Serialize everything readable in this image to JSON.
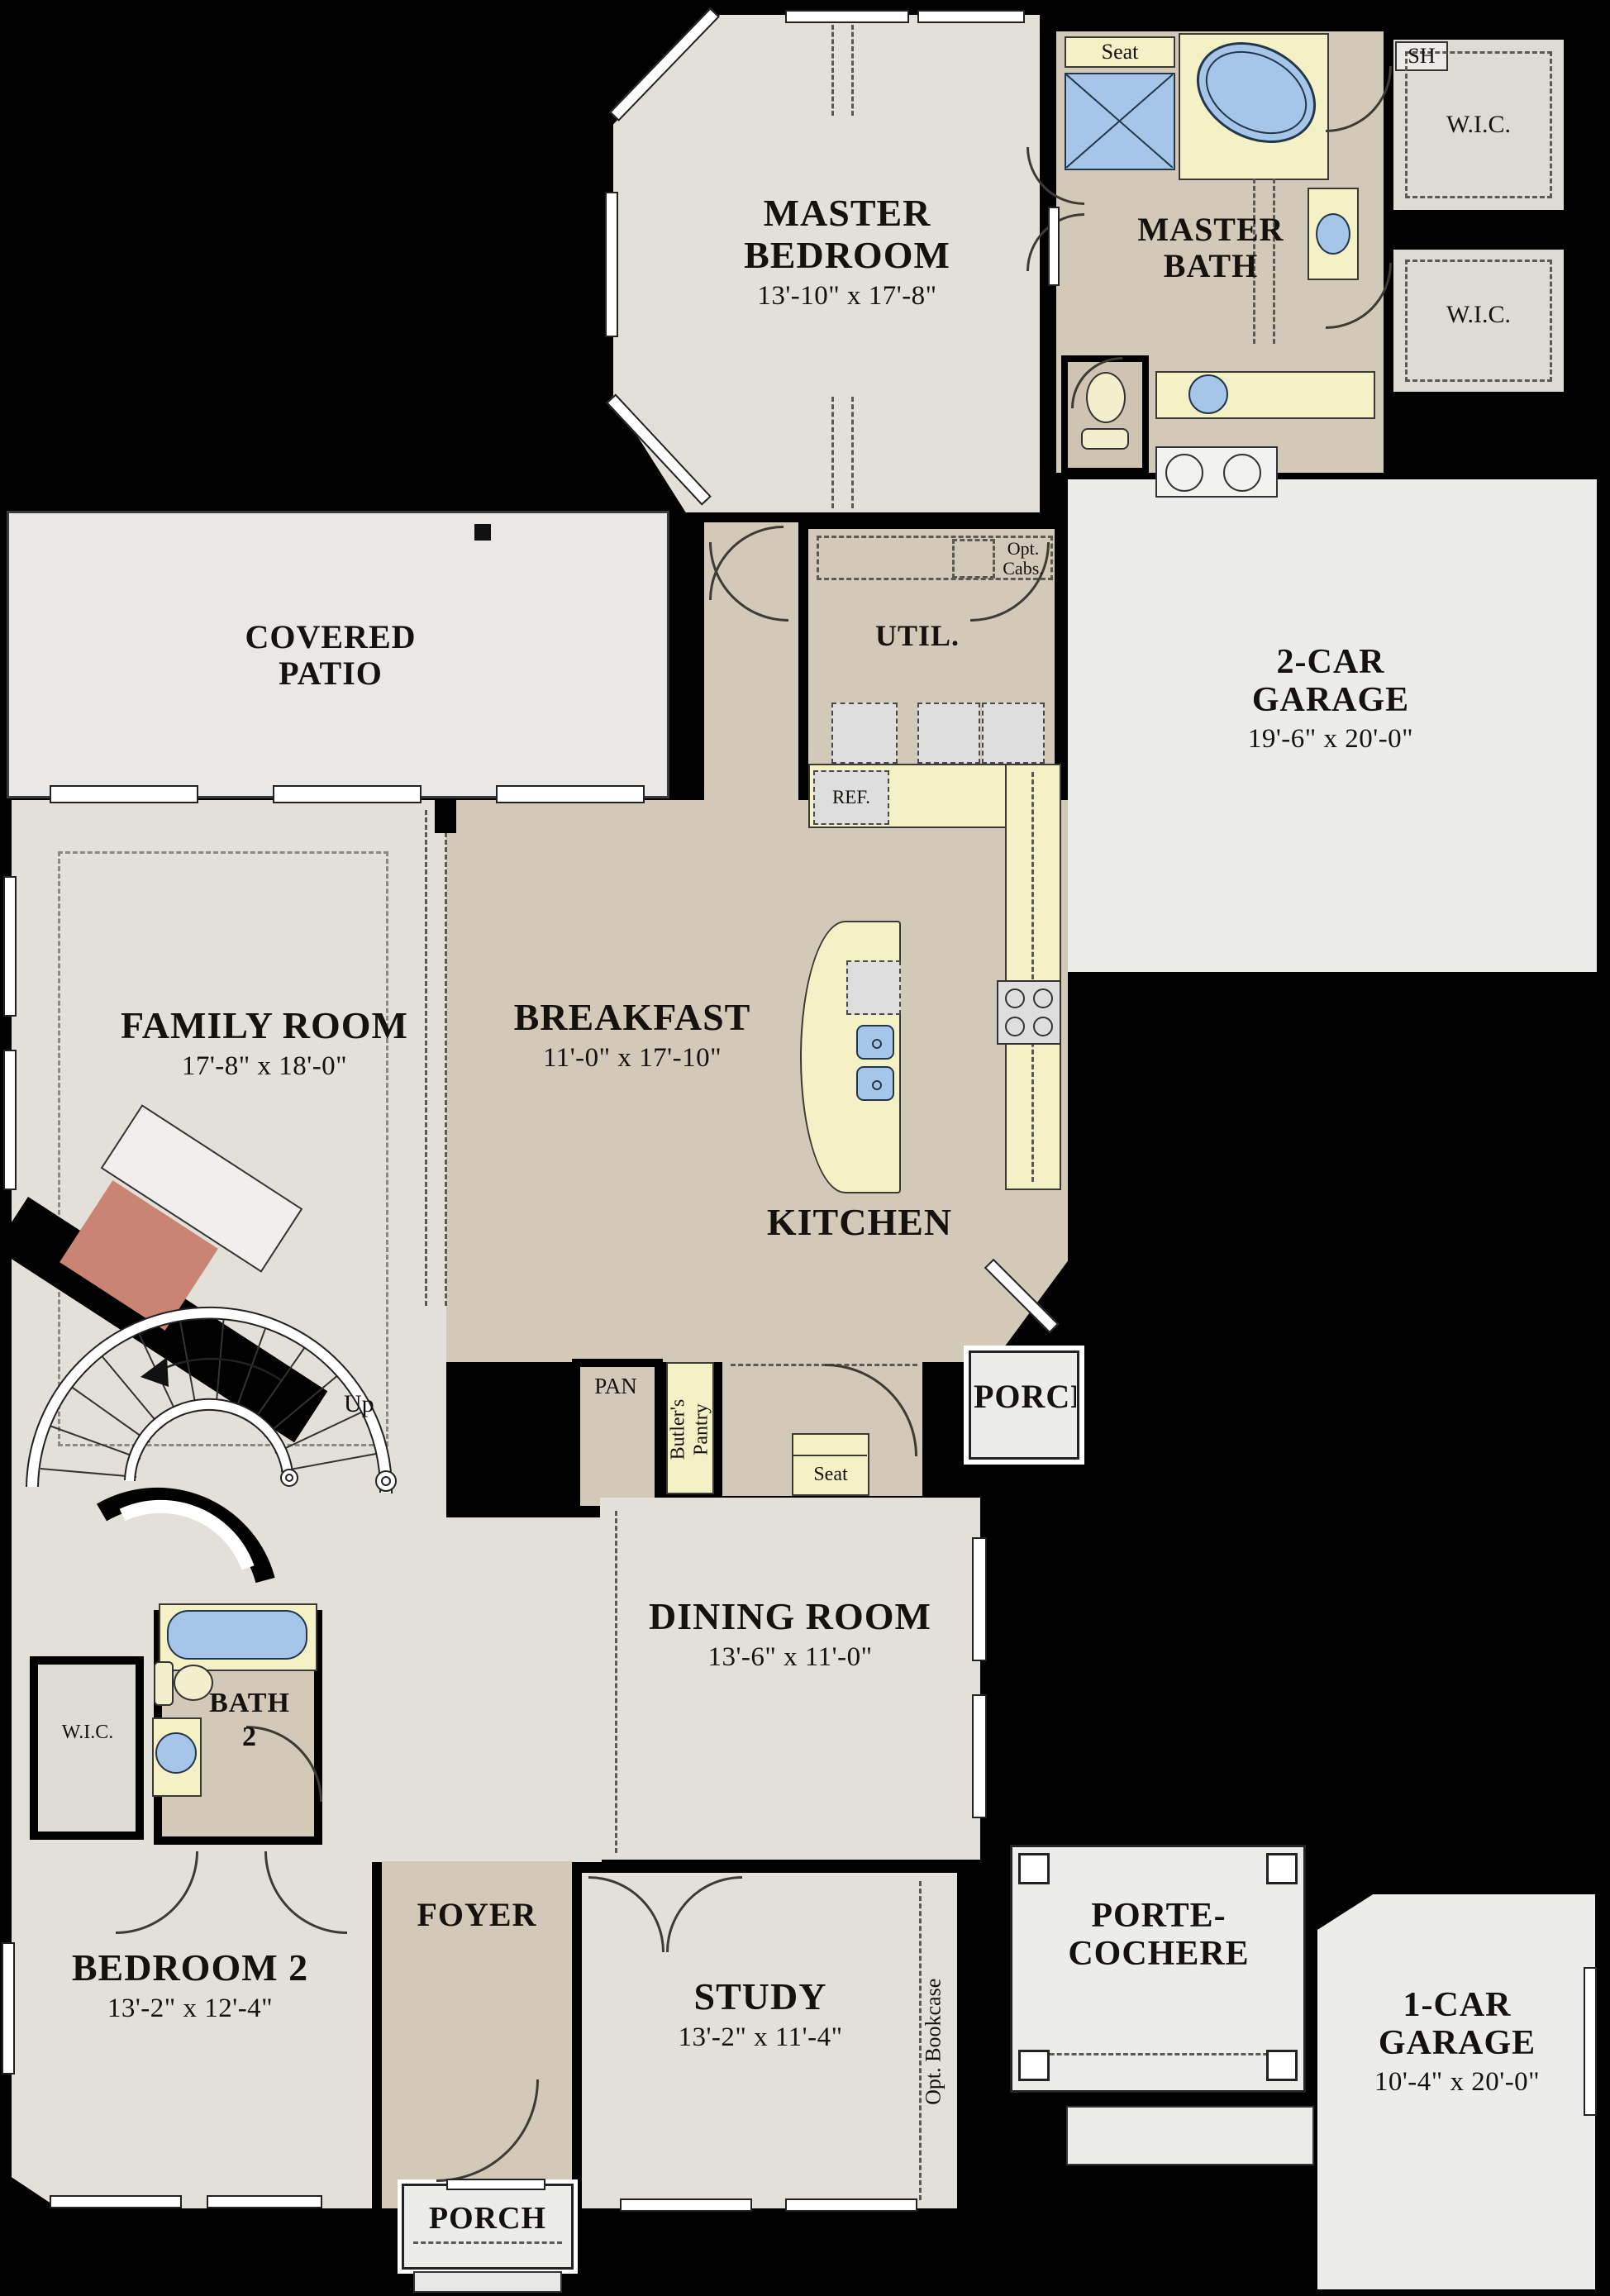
{
  "colors": {
    "background": "#000000",
    "room_light": "#e3e0da",
    "room_tan": "#d3c9b9",
    "room_gray": "#ececea",
    "closet_gray": "#dedbd5",
    "counter_yellow": "#f5f1c6",
    "fixture_blue": "#a5c6e8",
    "fixture_yellow": "#f3efcd",
    "appliance_gray": "#dedede",
    "fireplace": "#c98473",
    "wall": "#000000",
    "line": "#333333"
  },
  "rooms": {
    "master_bedroom": {
      "name": "MASTER BEDROOM",
      "dims": "13'-10\" x 17'-8\""
    },
    "master_bath": {
      "name": "MASTER BATH",
      "seat": "Seat",
      "shower": "SH"
    },
    "wic_master_top": {
      "name": "W.I.C."
    },
    "wic_master_bottom": {
      "name": "W.I.C."
    },
    "covered_patio": {
      "name": "COVERED PATIO"
    },
    "utility": {
      "name": "UTIL.",
      "opt_cabs": "Opt. Cabs."
    },
    "garage_2car": {
      "name": "2-CAR GARAGE",
      "dims": "19'-6\" x 20'-0\""
    },
    "family_room": {
      "name": "FAMILY ROOM",
      "dims": "17'-8\" x 18'-0\""
    },
    "breakfast": {
      "name": "BREAKFAST",
      "dims": "11'-0\" x 17'-10\""
    },
    "kitchen": {
      "name": "KITCHEN",
      "ref": "REF.",
      "pantry": "PAN",
      "butlers_pantry": "Butler's Pantry"
    },
    "mud_hall": {
      "seat": "Seat"
    },
    "porch_side": {
      "name": "PORCH"
    },
    "dining_room": {
      "name": "DINING ROOM",
      "dims": "13'-6\" x 11'-0\""
    },
    "stairs": {
      "label": "Up"
    },
    "bath2": {
      "name": "BATH 2"
    },
    "wic_bed2": {
      "name": "W.I.C."
    },
    "bedroom2": {
      "name": "BEDROOM 2",
      "dims": "13'-2\" x 12'-4\""
    },
    "foyer": {
      "name": "FOYER"
    },
    "study": {
      "name": "STUDY",
      "dims": "13'-2\" x 11'-4\"",
      "opt_bookcase": "Opt. Bookcase"
    },
    "porte_cochere": {
      "name": "PORTE-COCHERE"
    },
    "garage_1car": {
      "name": "1-CAR GARAGE",
      "dims": "10'-4\" x 20'-0\""
    },
    "porch_front": {
      "name": "PORCH"
    }
  }
}
